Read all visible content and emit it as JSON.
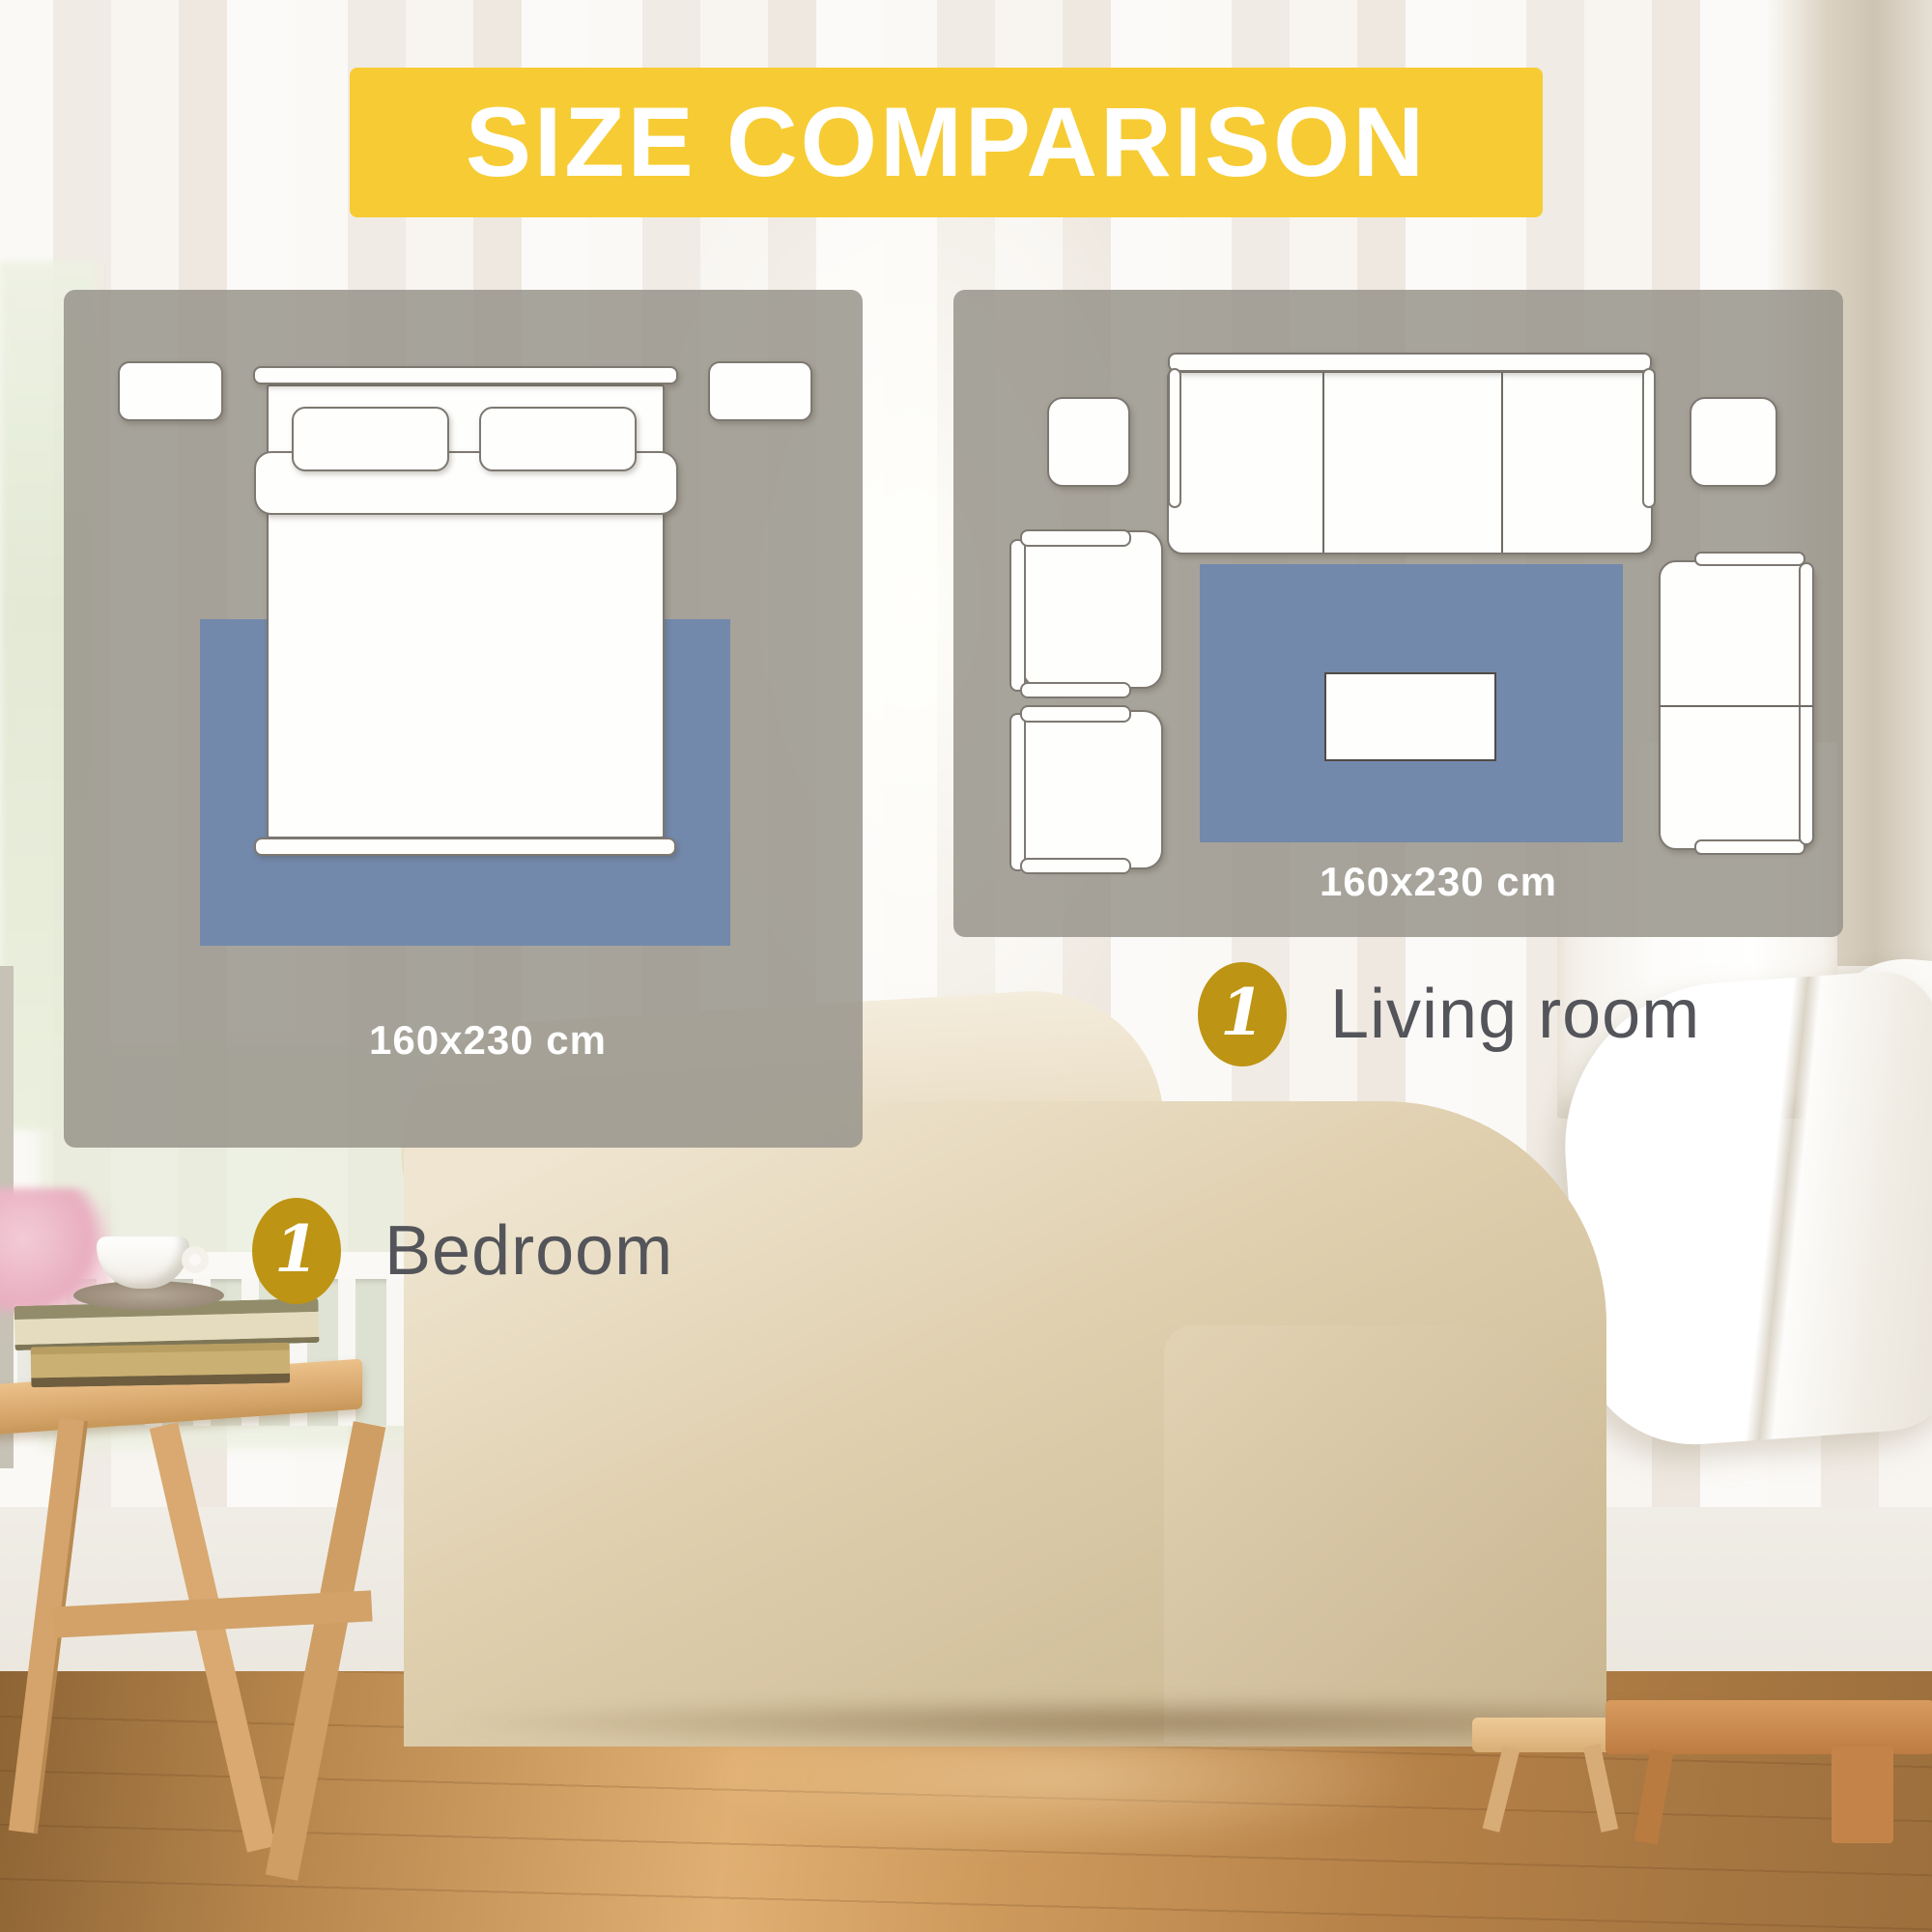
{
  "title_banner": {
    "label": "SIZE COMPARISON"
  },
  "bedroom": {
    "size_label": "160x230 cm",
    "badge_number": "1",
    "caption": "Bedroom"
  },
  "living_room": {
    "size_label": "160x230 cm",
    "badge_number": "1",
    "caption": "Living room"
  },
  "colors": {
    "banner_yellow": "#F7CB33",
    "badge_gold": "#BD9413",
    "rug_blue": "#7389AC",
    "panel_overlay": "rgba(152,148,139,0.85)",
    "caption_text": "#54555A",
    "size_label_text": "#FFFFFF"
  }
}
